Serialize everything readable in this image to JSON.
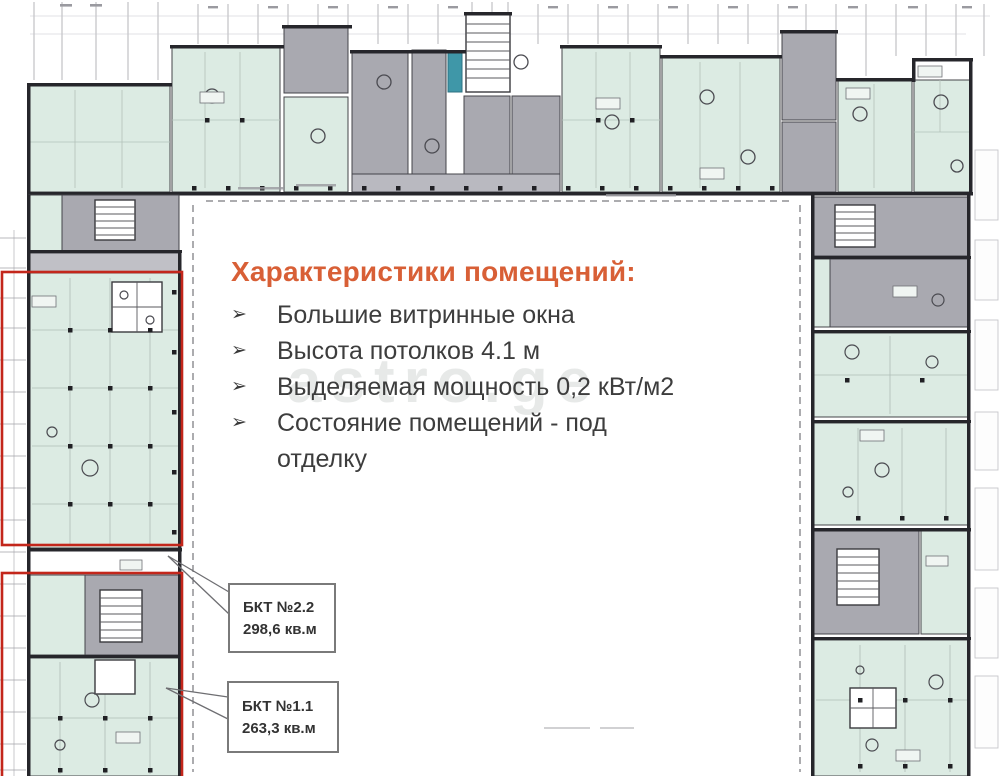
{
  "info_panel": {
    "title": "Характеристики помещений:",
    "bullet_marker": "➢",
    "bullets": [
      "Большие витринные окна",
      "Высота потолков 4.1 м",
      "Выделяемая мощность 0,2 кВт/м2",
      "Состояние помещений - под\nотделку"
    ]
  },
  "unit_labels": [
    {
      "name": "БКТ №2.2",
      "area": "298,6 кв.м"
    },
    {
      "name": "БКТ №1.1",
      "area": "263,3 кв.м"
    }
  ],
  "watermark": "astro.ge",
  "palette": {
    "room_fill": "#dcebe3",
    "core_fill": "#a9a9b0",
    "wall": "#26262b",
    "highlight_room": "#3f97a8",
    "selection_outline": "#c3261b",
    "accent_heading": "#d85f36",
    "body_text": "#3d3d3d"
  }
}
